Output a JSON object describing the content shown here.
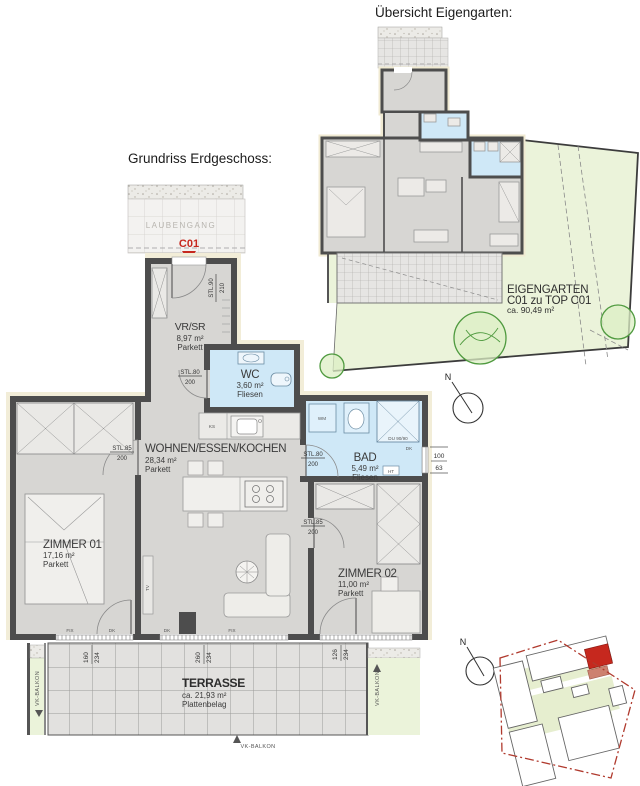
{
  "titles": {
    "overview": "Übersicht Eigengarten:",
    "ground_floor": "Grundriss Erdgeschoss:"
  },
  "unit": {
    "id": "C01"
  },
  "labels": {
    "laubengang": "LAUBENGANG",
    "vk_balkon": "VK-BALKON",
    "north": "N"
  },
  "rooms": {
    "vrsr": {
      "name": "VR/SR",
      "area": "8,97 m²",
      "floor": "Parkett"
    },
    "wc": {
      "name": "WC",
      "area": "3,60 m²",
      "floor": "Fliesen"
    },
    "wohnen": {
      "name": "WOHNEN/ESSEN/KOCHEN",
      "area": "28,34 m²",
      "floor": "Parkett"
    },
    "bad": {
      "name": "BAD",
      "area": "5,49 m²",
      "floor": "Fliesen"
    },
    "zimmer01": {
      "name": "ZIMMER 01",
      "area": "17,16 m²",
      "floor": "Parkett"
    },
    "zimmer02": {
      "name": "ZIMMER 02",
      "area": "11,00 m²",
      "floor": "Parkett"
    },
    "terrasse": {
      "name": "TERRASSE",
      "area": "ca. 21,93 m²",
      "floor": "Plattenbelag"
    }
  },
  "garden": {
    "name": "EIGENGARTEN",
    "assignment": "C01 zu TOP C01",
    "area": "ca. 90,49 m²"
  },
  "door_labels": {
    "entry": {
      "type": "STL.90",
      "height": "210"
    },
    "wc": {
      "type": "STL.80",
      "height": "200"
    },
    "zimmer01": {
      "type": "STL.85",
      "height": "200"
    },
    "bad": {
      "type": "STL.80",
      "height": "200"
    },
    "zimmer02": {
      "type": "STL.85",
      "height": "200"
    }
  },
  "fixtures": {
    "fridge": "KS",
    "washer": "WM",
    "tv": "TV",
    "heater": "HT",
    "shower": "DU 90/90",
    "vent": "DK"
  },
  "window_labels": {
    "w1": "FIX",
    "w2": "DK",
    "w3": "DK",
    "w4": "FIX"
  },
  "window_dims": [
    {
      "w": "160",
      "h": "234"
    },
    {
      "w": "260",
      "h": "234"
    },
    {
      "w": "126",
      "h": "234"
    }
  ],
  "bath_window_dim": {
    "w": "100",
    "h": "63"
  },
  "colors": {
    "wall": "#4d4d4d",
    "wet_room": "#cfe8f7",
    "garden": "#ebf3da",
    "terrace_tile": "#e2e1df",
    "accent_red": "#c6281e",
    "insulation": "#f2edd8"
  }
}
